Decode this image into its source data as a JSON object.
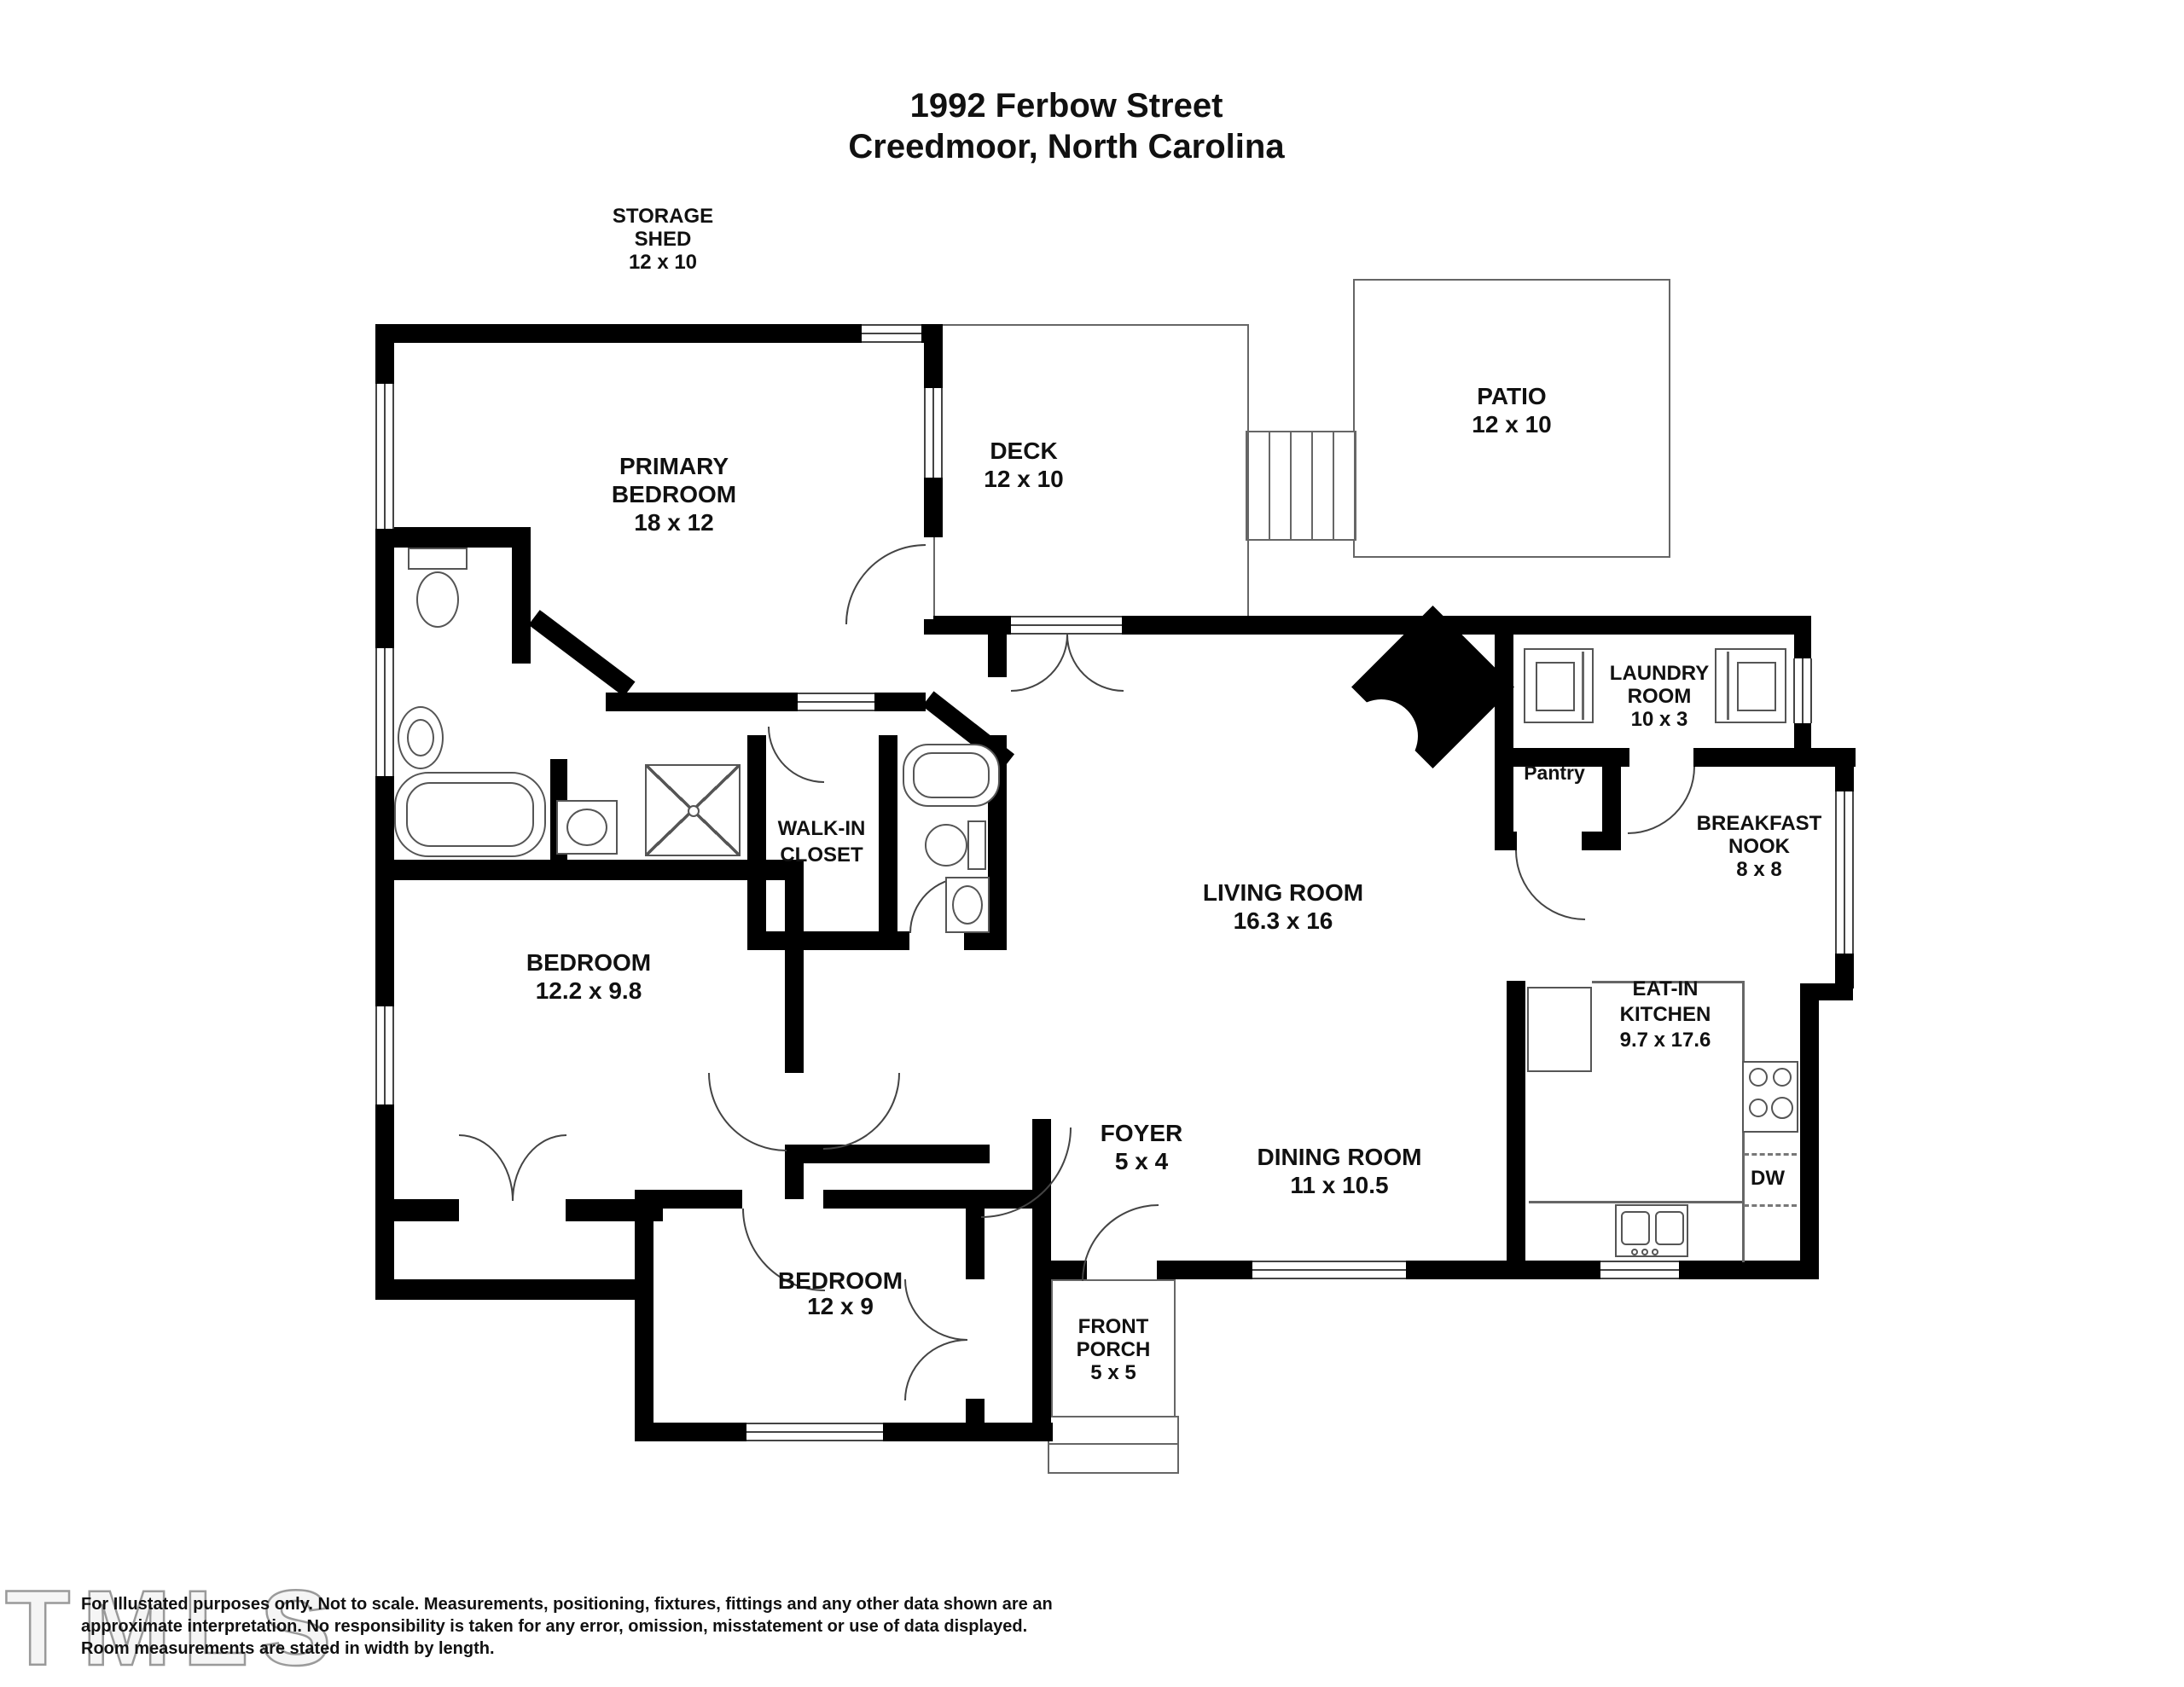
{
  "title": {
    "line1": "1992 Ferbow Street",
    "line2": "Creedmoor, North Carolina"
  },
  "rooms": {
    "storage_shed": {
      "l1": "STORAGE",
      "l2": "SHED",
      "dims": "12 x 10"
    },
    "primary_bedroom": {
      "l1": "PRIMARY",
      "l2": "BEDROOM",
      "dims": "18 x 12"
    },
    "deck": {
      "l1": "DECK",
      "dims": "12 x 10"
    },
    "patio": {
      "l1": "PATIO",
      "dims": "12 x 10"
    },
    "laundry_room": {
      "l1": "LAUNDRY",
      "l2": "ROOM",
      "dims": "10 x 3"
    },
    "pantry": {
      "l1": "Pantry"
    },
    "breakfast_nook": {
      "l1": "BREAKFAST",
      "l2": "NOOK",
      "dims": "8 x 8"
    },
    "living_room": {
      "l1": "LIVING ROOM",
      "dims": "16.3 x 16"
    },
    "walk_in_closet": {
      "l1": "WALK-IN",
      "l2": "CLOSET"
    },
    "eat_in_kitchen": {
      "l1": "EAT-IN",
      "l2": "KITCHEN",
      "dims": "9.7 x 17.6"
    },
    "bedroom2": {
      "l1": "BEDROOM",
      "dims": "12.2 x 9.8"
    },
    "foyer": {
      "l1": "FOYER",
      "dims": "5 x 4"
    },
    "dining_room": {
      "l1": "DINING ROOM",
      "dims": "11 x 10.5"
    },
    "bedroom3": {
      "l1": "BEDROOM",
      "dims": "12 x 9"
    },
    "front_porch": {
      "l1": "FRONT",
      "l2": "PORCH",
      "dims": "5 x 5"
    },
    "dishwasher": {
      "l1": "DW"
    }
  },
  "footer": {
    "disclaimer_line1": "For Illustated purposes only. Not to scale. Measurements, positioning, fixtures, fittings and any other data shown are an",
    "disclaimer_line2": "approximate interpretation. No responsibility is taken for any error, omission, misstatement or use of data displayed.",
    "disclaimer_line3": "Room measurements are stated in width by length.",
    "watermark": "TMLS"
  },
  "colors": {
    "wall": "#000000",
    "thin_line": "#666666",
    "text": "#111111",
    "watermark": "#9a9a9a"
  }
}
